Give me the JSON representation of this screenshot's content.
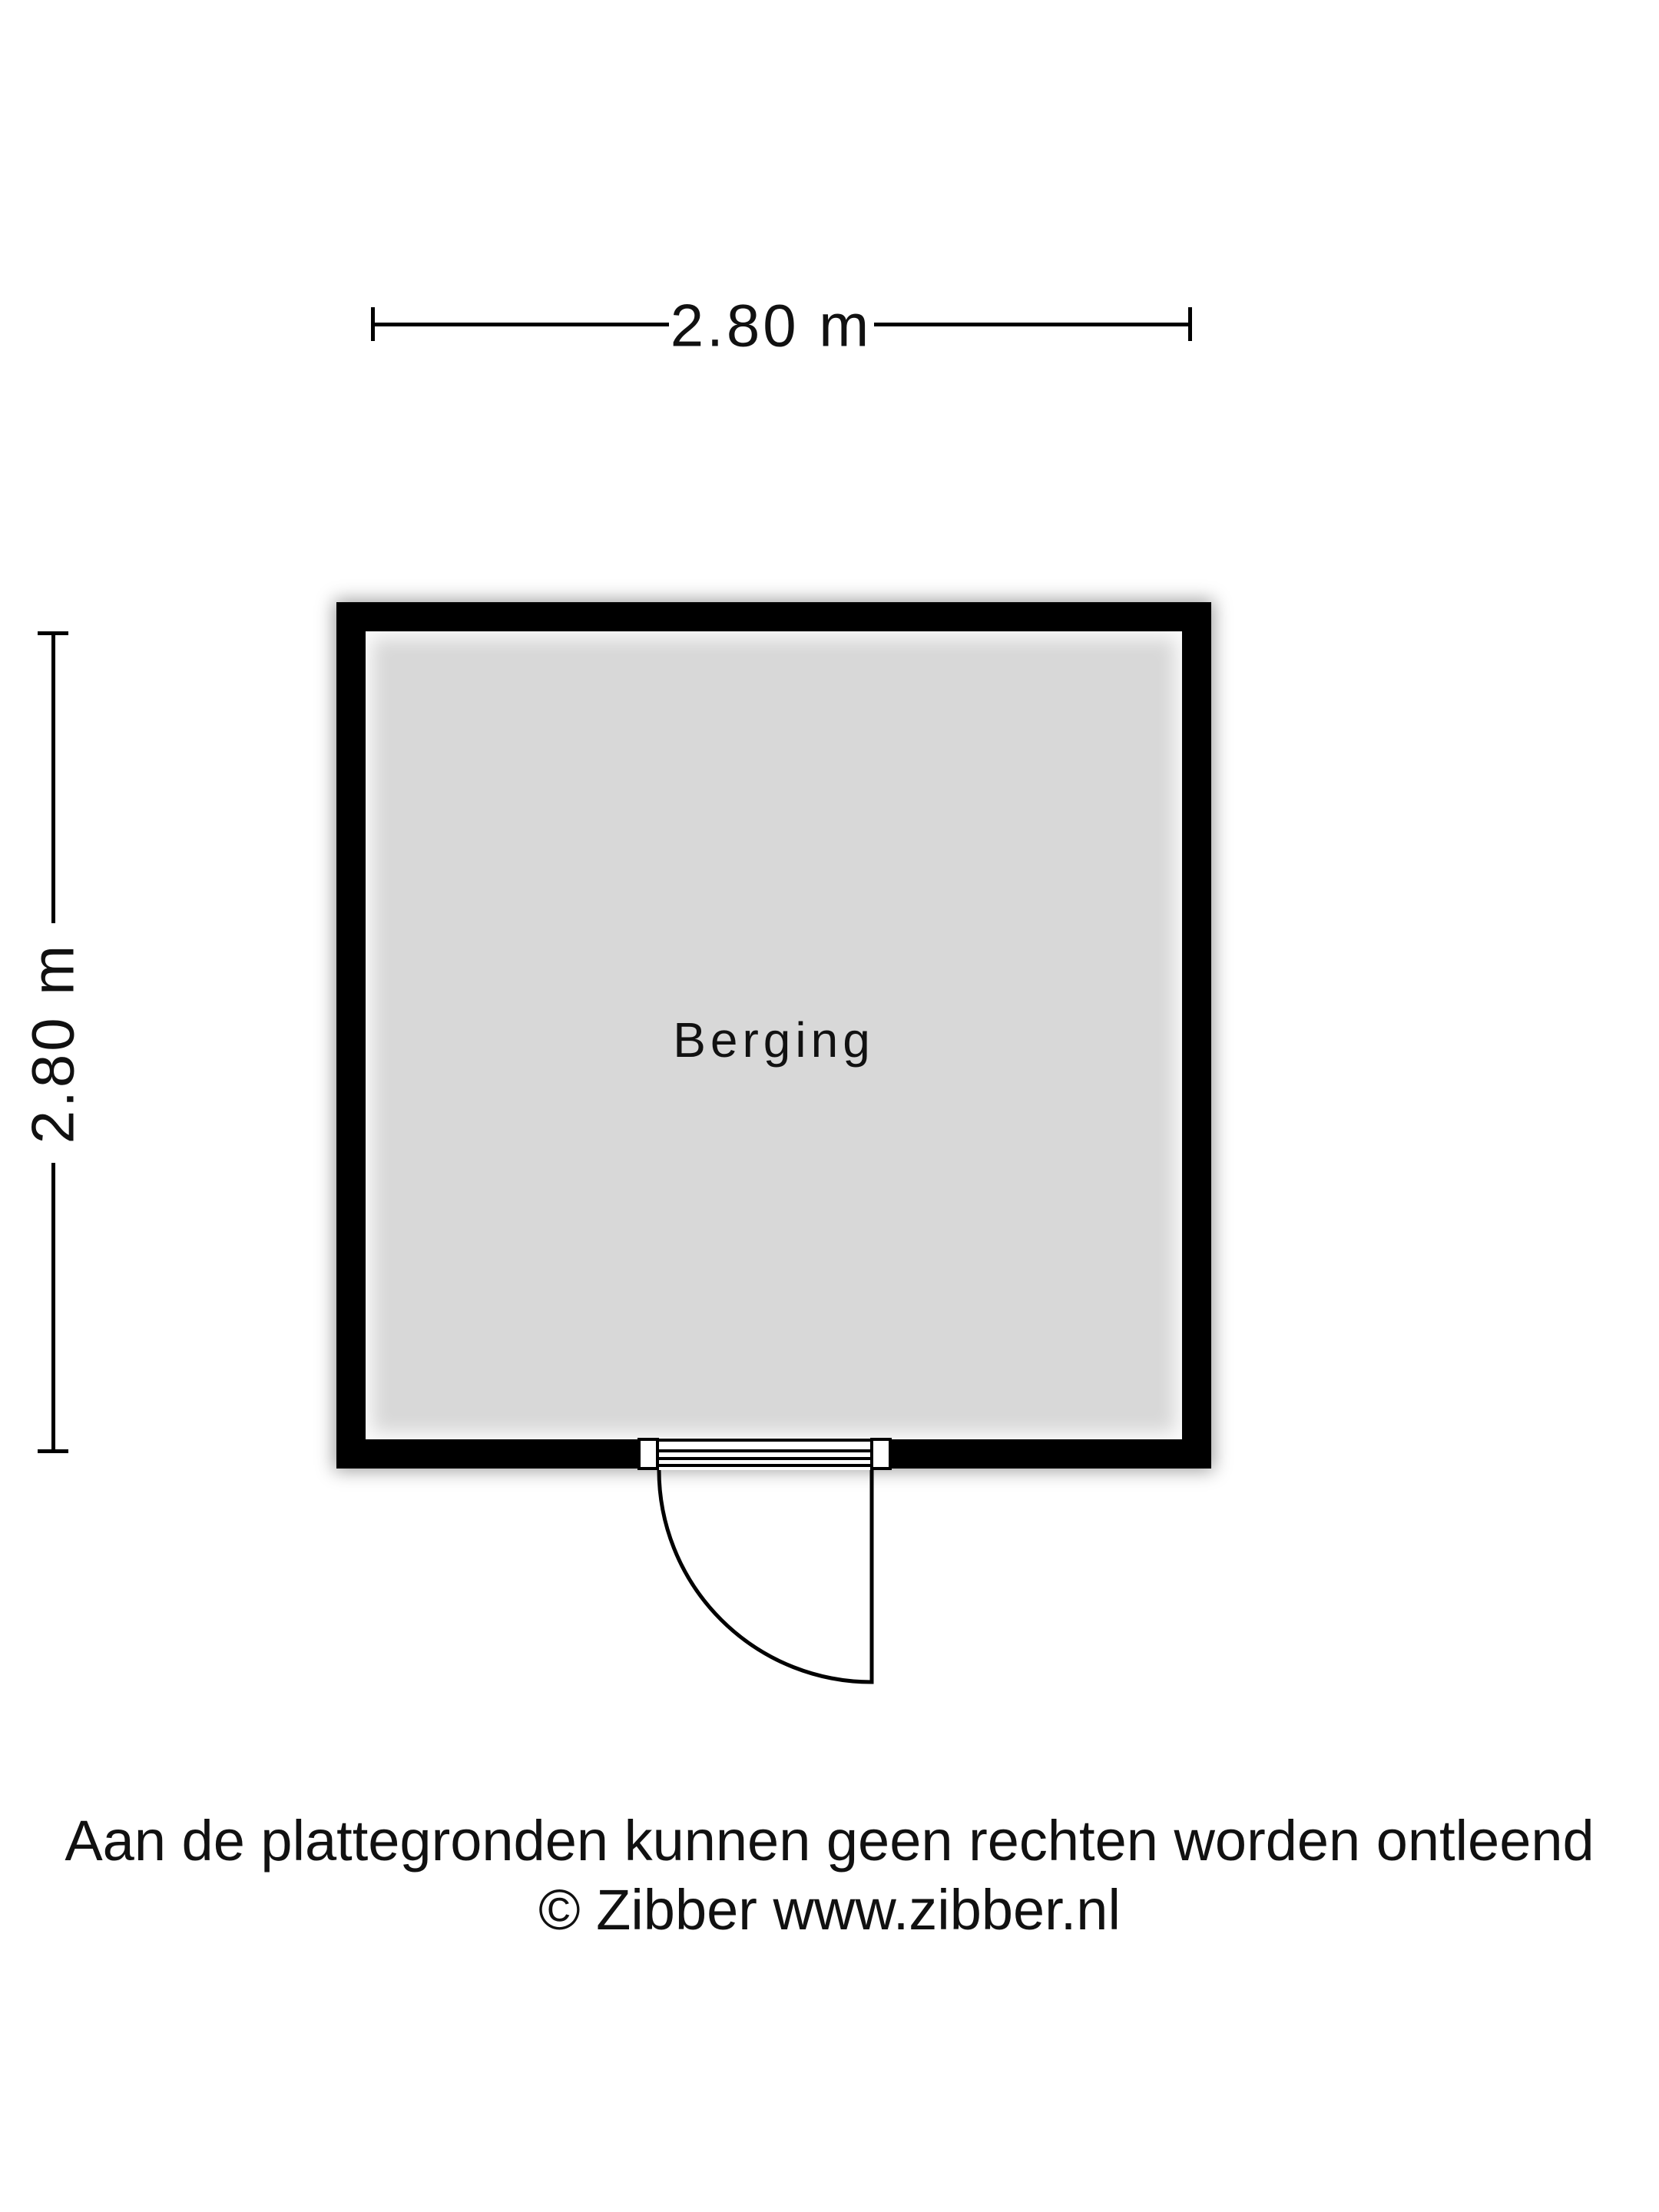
{
  "floorplan": {
    "room_label": "Berging",
    "dimension_top": "2.80 m",
    "dimension_left": "2.80 m"
  },
  "footer": {
    "disclaimer": "Aan de plattegronden kunnen geen rechten worden ontleend",
    "copyright": "© Zibber www.zibber.nl"
  },
  "colors": {
    "wall": "#000000",
    "floor": "#d8d8d8",
    "background": "#ffffff"
  }
}
